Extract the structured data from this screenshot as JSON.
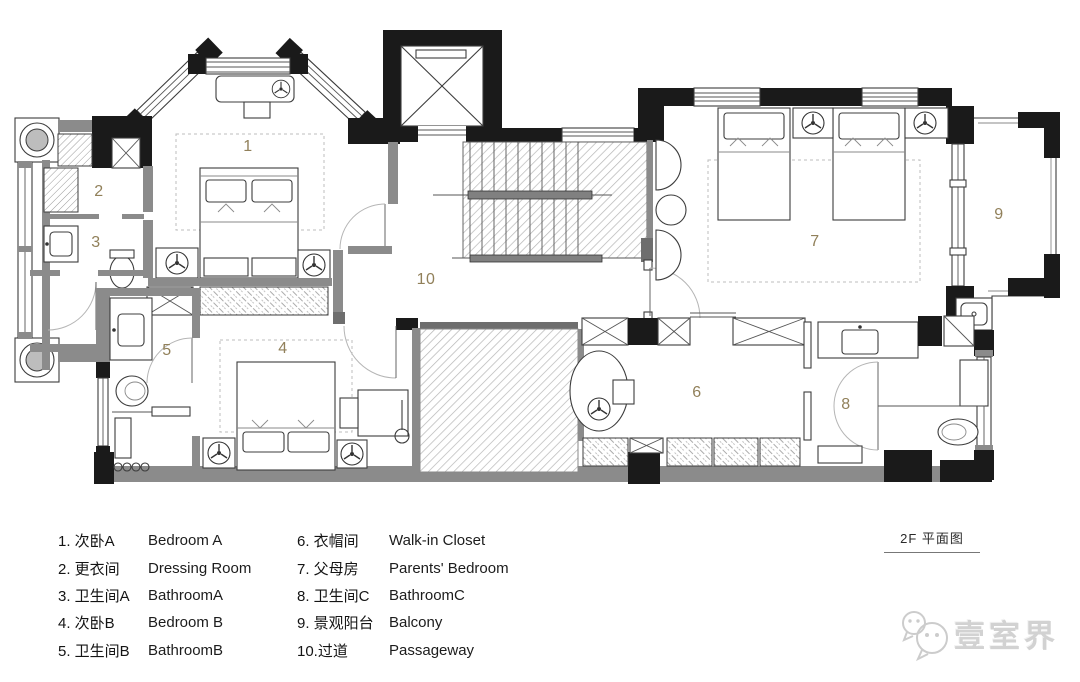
{
  "title": {
    "label": "2F 平面图"
  },
  "watermark": {
    "brand": "壹室界",
    "icon": "wechat-bubbles-icon"
  },
  "plan": {
    "colors": {
      "wall_black": "#1a1a1a",
      "wall_gray": "#8b8b8b",
      "room_label": "#91805a"
    },
    "rooms": [
      {
        "num": "1",
        "zh": "次卧A",
        "en": "Bedroom A",
        "x": 248,
        "y": 147
      },
      {
        "num": "2",
        "zh": "更衣间",
        "en": "Dressing Room",
        "x": 99,
        "y": 192
      },
      {
        "num": "3",
        "zh": "卫生间A",
        "en": "BathroomA",
        "x": 96,
        "y": 243
      },
      {
        "num": "4",
        "zh": "次卧B",
        "en": "Bedroom B",
        "x": 283,
        "y": 349
      },
      {
        "num": "5",
        "zh": "卫生间B",
        "en": "BathroomB",
        "x": 167,
        "y": 351
      },
      {
        "num": "6",
        "zh": "衣帽间",
        "en": "Walk-in Closet",
        "x": 697,
        "y": 393
      },
      {
        "num": "7",
        "zh": "父母房",
        "en": "Parents' Bedroom",
        "x": 815,
        "y": 242
      },
      {
        "num": "8",
        "zh": "卫生间C",
        "en": "BathroomC",
        "x": 846,
        "y": 405
      },
      {
        "num": "9",
        "zh": "景观阳台",
        "en": "Balcony",
        "x": 999,
        "y": 215
      },
      {
        "num": "10",
        "zh": "过道",
        "en": "Passageway",
        "x": 426,
        "y": 280
      }
    ]
  },
  "legend": {
    "columns": [
      {
        "items": [
          {
            "zh_label": "1. 次卧A",
            "en_label": "Bedroom A"
          },
          {
            "zh_label": "2. 更衣间",
            "en_label": "Dressing Room"
          },
          {
            "zh_label": "3. 卫生间A",
            "en_label": "BathroomA"
          },
          {
            "zh_label": "4. 次卧B",
            "en_label": "Bedroom B"
          },
          {
            "zh_label": "5. 卫生间B",
            "en_label": "BathroomB"
          }
        ]
      },
      {
        "items": [
          {
            "zh_label": "6. 衣帽间",
            "en_label": "Walk-in Closet"
          },
          {
            "zh_label": "7. 父母房",
            "en_label": "Parents' Bedroom"
          },
          {
            "zh_label": "8. 卫生间C",
            "en_label": "BathroomC"
          },
          {
            "zh_label": "9. 景观阳台",
            "en_label": "Balcony"
          },
          {
            "zh_label": "10.过道",
            "en_label": "Passageway"
          }
        ]
      }
    ]
  }
}
